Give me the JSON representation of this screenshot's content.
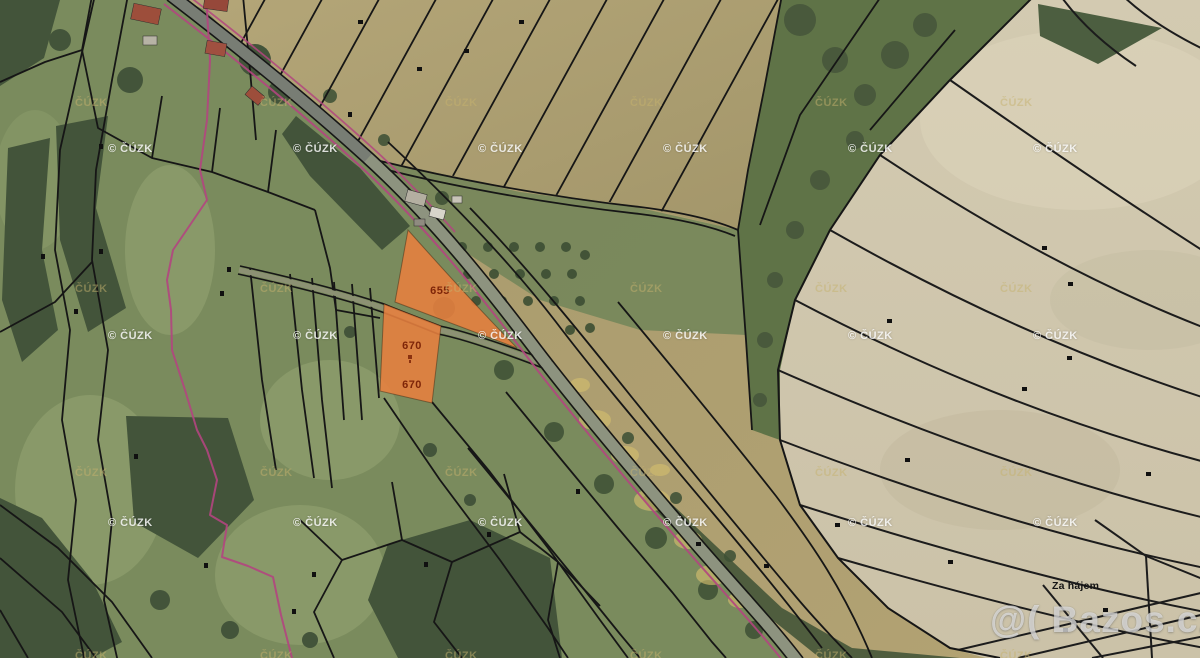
{
  "map": {
    "highlighted_parcels": [
      {
        "number": "655"
      },
      {
        "number": "670"
      },
      {
        "number": "670"
      }
    ],
    "place_label": "Za hájem"
  },
  "watermarks": {
    "cuzk_white": {
      "text": "© ČÚZK",
      "xs": [
        108,
        293,
        478,
        663,
        848,
        1033
      ],
      "ys": [
        143,
        330,
        517
      ]
    },
    "cuzk_tan": {
      "text": "ČÚZK",
      "xs": [
        75,
        260,
        445,
        630,
        815,
        1000
      ],
      "ys": [
        97,
        283,
        467,
        650
      ]
    },
    "bazos": {
      "text": "@( Bazos.cz"
    }
  },
  "colors": {
    "parcel_highlight": "#e8803f",
    "parcel_number_text": "#7e2508",
    "cadastral_line": "#161616",
    "boundary_magenta": "#b3457f",
    "watermark_white": "rgba(255,255,255,0.82)",
    "watermark_tan": "rgba(198,178,110,0.5)",
    "bazos_watermark": "rgba(255,255,255,0.6)"
  }
}
